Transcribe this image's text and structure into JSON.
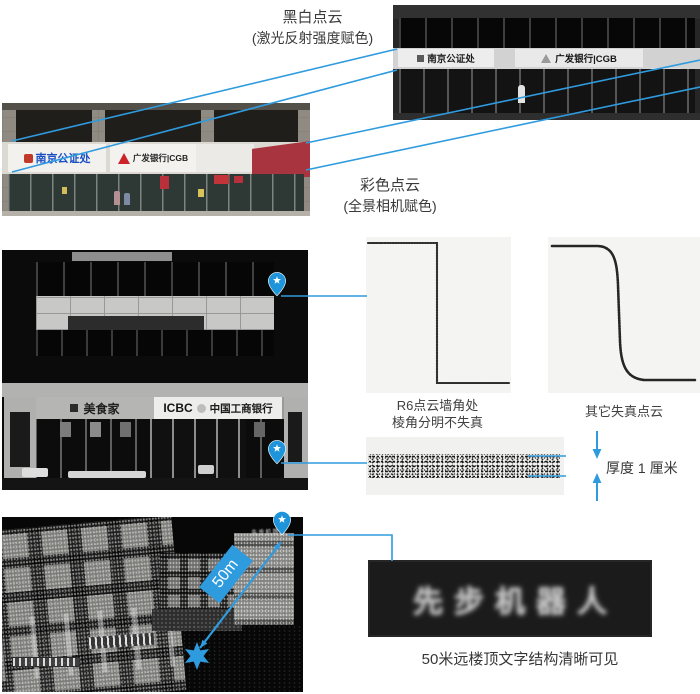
{
  "colors": {
    "accent_blue": "#2f9bdf",
    "pin_blue": "#1e95da",
    "cgb_red": "#cc2229",
    "notary_blue": "#1a4fc4",
    "awning_red": "#a8343f"
  },
  "top": {
    "bw_label": {
      "line1": "黑白点云",
      "line2": "(激光反射强度赋色)"
    },
    "color_label": {
      "line1": "彩色点云",
      "line2": "(全景相机赋色)"
    },
    "bw_photo": {
      "notary_sign": "南京公证处",
      "cgb_sign": "广发银行|CGB"
    },
    "color_photo": {
      "notary_sign": "南京公证处",
      "cgb_sign": "广发银行|CGB"
    }
  },
  "middle": {
    "facade_photo": {
      "foodie_sign": "美食家",
      "icbc_abbr": "ICBC",
      "icbc_name": "中国工商银行"
    },
    "r6_caption": {
      "line1": "R6点云墙角处",
      "line2": "棱角分明不失真"
    },
    "other_caption": "其它失真点云",
    "thickness_label": "厚度 1 厘米"
  },
  "bottom": {
    "distance_badge": "50m",
    "rooftop_text": "先步机器人",
    "caption": "50米远楼顶文字结构清晰可见"
  }
}
